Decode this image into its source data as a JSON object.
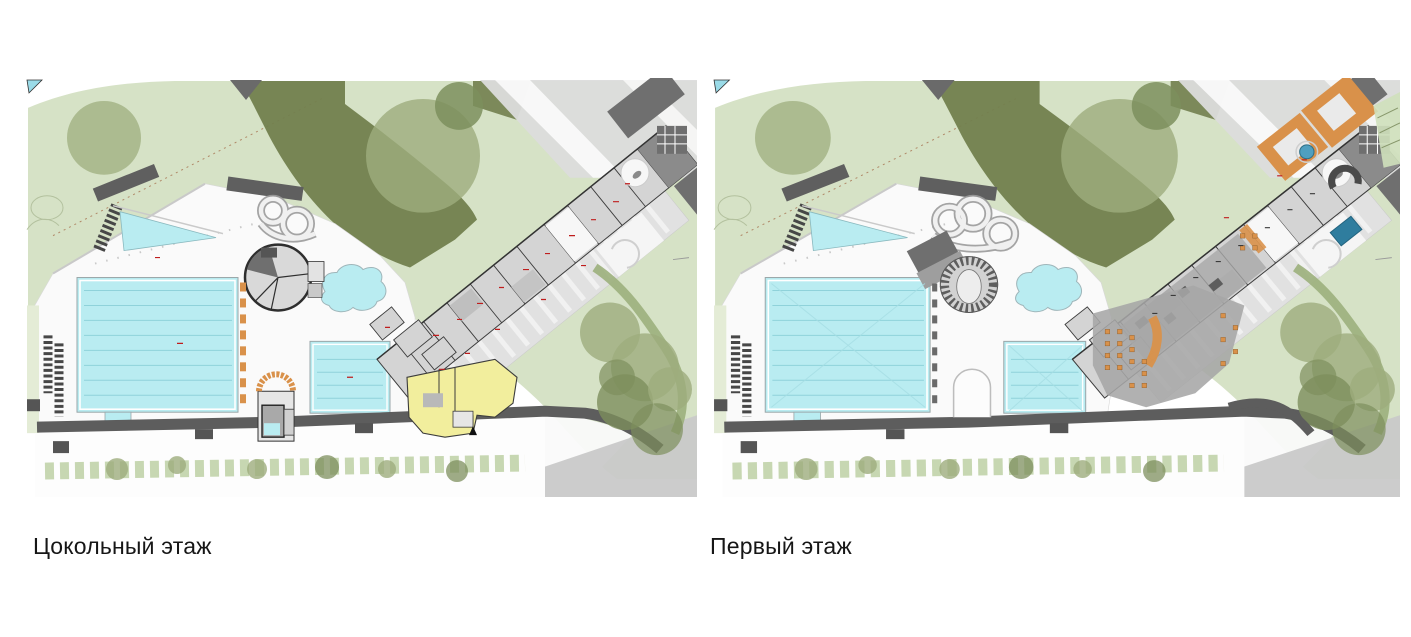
{
  "page": {
    "background": "#ffffff"
  },
  "panels": [
    {
      "id": "basement-floor",
      "caption": "Цокольный этаж"
    },
    {
      "id": "first-floor",
      "caption": "Первый этаж"
    }
  ],
  "palette": {
    "page_bg": "#ffffff",
    "caption": "#161616",
    "park_green": "#d6e2c6",
    "park_deep": "#72804e",
    "tree_green": "#9dad7d",
    "tree_deep": "#7d8f5d",
    "pool_cyan": "#b9ecf1",
    "pool_lane": "#8fd2da",
    "deep_pool_blue": "#2f7d9e",
    "deck_white": "#fafafa",
    "wall_dark": "#3c3c3c",
    "room_gray": "#d4d4d4",
    "room_dark": "#6f6f6f",
    "terrace_gray": "#e1e1e1",
    "plaza_gray": "#a6a6a6",
    "road_dark": "#5d5d5d",
    "road_light": "#c9c9c9",
    "hedge_green": "#c5d6ae",
    "highlight_yellow": "#f2ee9d",
    "accent_orange": "#d9914a",
    "annotation_red": "#bf1d1d"
  }
}
